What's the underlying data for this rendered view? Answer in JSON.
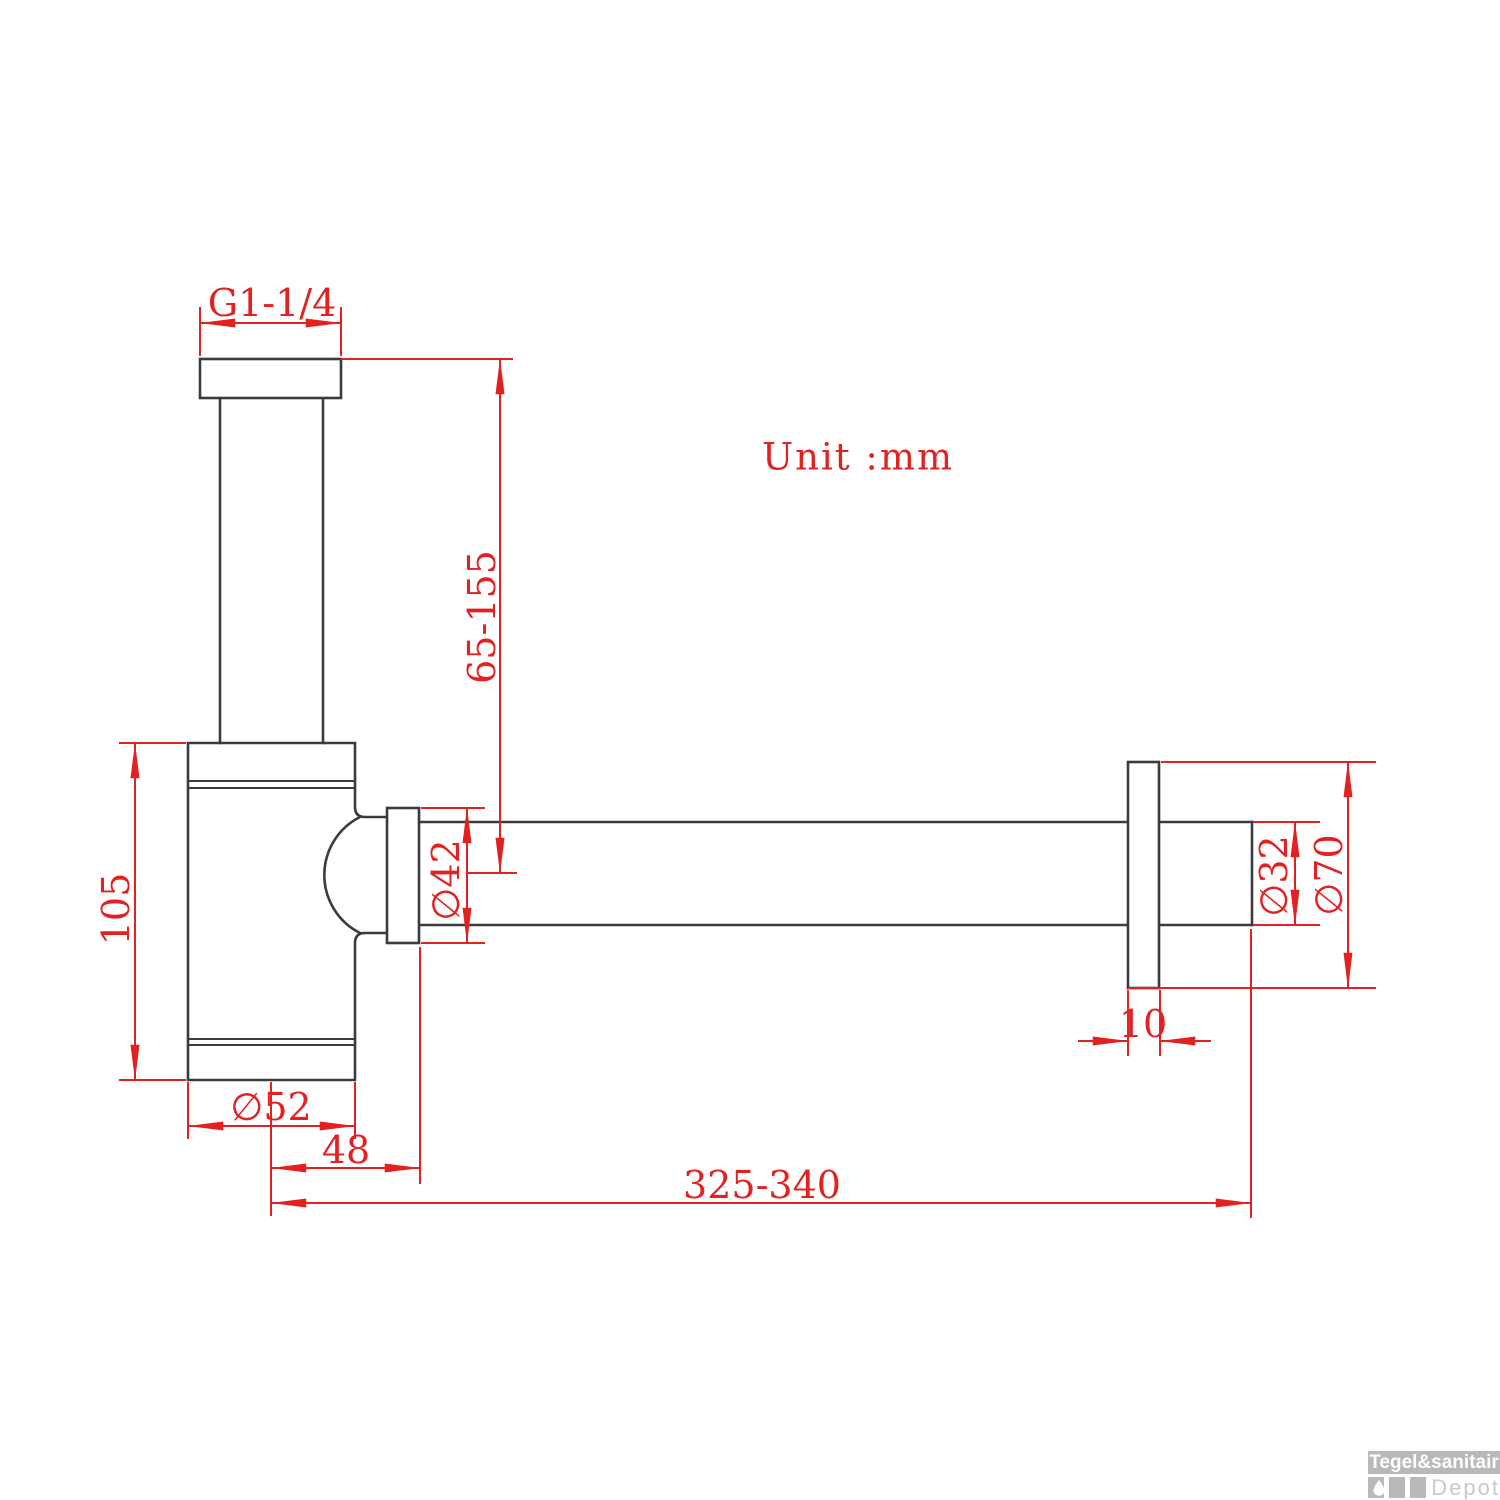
{
  "drawing": {
    "unit_note": "Unit :mm",
    "labels": {
      "thread": "G1-1/4",
      "inlet_height": "65-155",
      "body_height": "105",
      "nut_diameter": "∅42",
      "body_diameter": "∅52",
      "body_to_pipe_offset": "48",
      "total_length": "325-340",
      "pipe_diameter": "∅32",
      "rosette_diameter": "∅70",
      "rosette_thickness": "10"
    },
    "colors": {
      "dimension_red": "#e42121",
      "outline_black": "#3b3b3b",
      "watermark_gray": "#b9b9b9"
    }
  },
  "watermark": {
    "brand": "Tegel&sanitair",
    "sub_brand": "Depot"
  }
}
